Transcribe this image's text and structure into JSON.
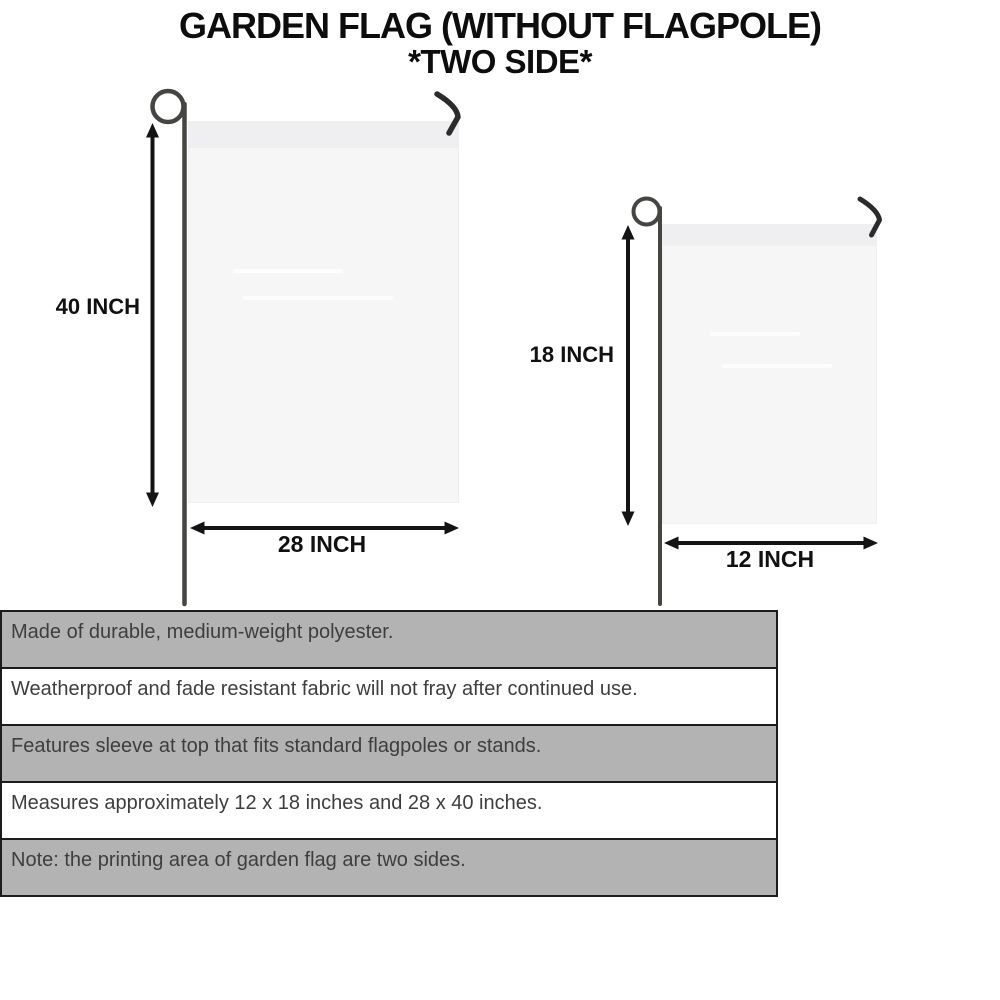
{
  "title": {
    "line1": "GARDEN FLAG (WITHOUT FLAGPOLE)",
    "line2": "*TWO SIDE*"
  },
  "measurements": {
    "large_flag": {
      "height_label": "40 INCH",
      "width_label": "28 INCH"
    },
    "small_flag": {
      "height_label": "18 INCH",
      "width_label": "12 INCH"
    }
  },
  "features": {
    "rows": [
      {
        "text": "Made of durable, medium-weight polyester.",
        "shaded": true
      },
      {
        "text": "Weatherproof and fade resistant fabric will not fray after continued use.",
        "shaded": false
      },
      {
        "text": "Features sleeve at top that fits standard flagpoles or stands.",
        "shaded": true
      },
      {
        "text": "Measures approximately 12 x 18 inches and 28 x 40 inches.",
        "shaded": false
      },
      {
        "text": "Note: the printing area of garden flag are two sides.",
        "shaded": true
      }
    ]
  },
  "colors": {
    "background": "#ffffff",
    "title_text": "#0d0d0d",
    "flag_fill": "#f6f6f7",
    "flag_sleeve": "#efeff1",
    "pole": "#454542",
    "hook": "#2b2b2b",
    "dimension_arrow": "#141414",
    "table_border": "#1c1c1c",
    "row_shaded_bg": "#b3b3b3",
    "row_plain_bg": "#ffffff",
    "row_text": "#3e3e3e"
  }
}
